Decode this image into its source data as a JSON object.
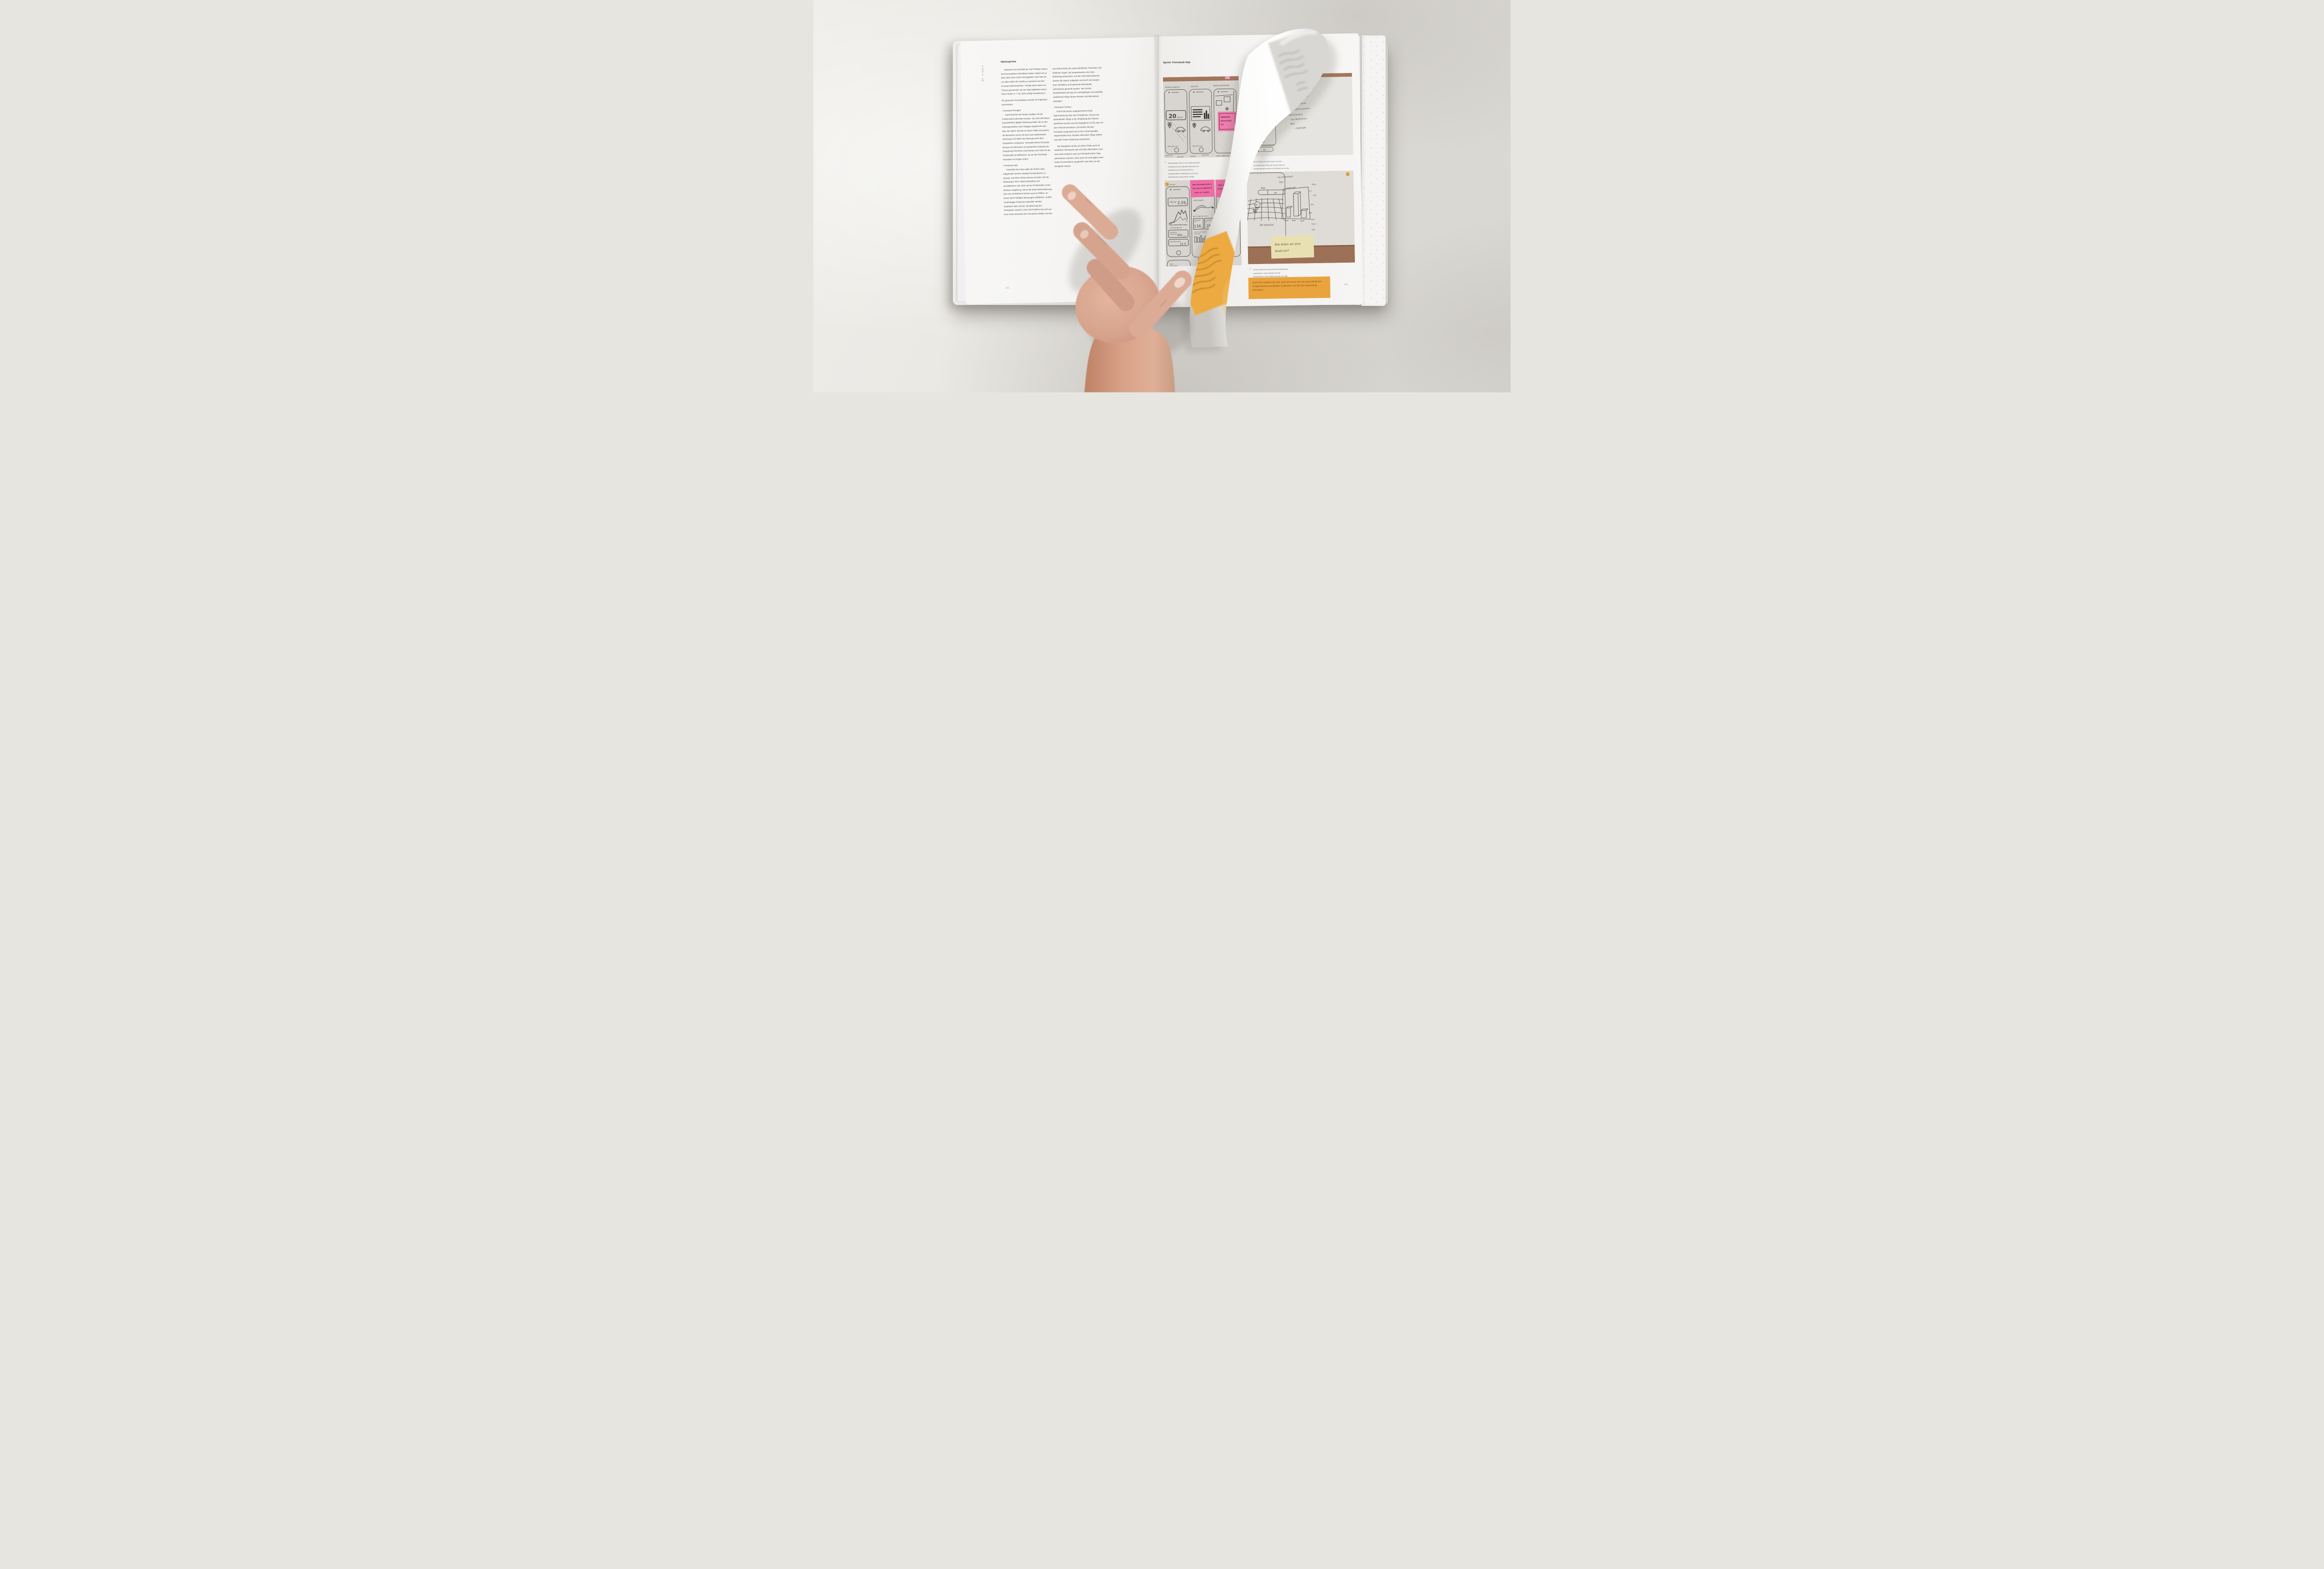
{
  "colors": {
    "accent_yellow": "#e9a43e",
    "sticky_pink": "#ee6fa6",
    "cork_brown": "#9c7157",
    "sticky_yellow": "#e9e0b2",
    "page": "#f5f4f2"
  },
  "left_page": {
    "side_label": "02 Create",
    "page_number": "182",
    "heading": "Ideensprints",
    "col1": {
      "p1": "Nachdem wir innerhalb der Top Findings unsere drei Konzeptideen identifiziert hatten, haben wir zu jeder Idee einen Sprint durchgeführt. Dies half uns vor allem dabei die Inhalte zu sammeln und das Konzept weiterzudenken. Parallel dazu haben wir Thesen gesammelt, die wie folgt aufgebaut waren: Wenn Nutzer X, Y tut, dann  erfolgt Auswirkung Z.",
      "p2": "Die gesamten Konzeptideen werden im Folgenden beschrieben:",
      "b1": "›  Feinstaub-Fernglas:",
      "p3": "Damit könnten die Nutzer häufiger mit der Problematik konfrontiert werden. Zur Zeit informieren ausschließlich digitale Reklameschilder die an den Zubringerstraßen nach Stuttgart angebracht sind über den Alarm. Bereits an dieser Stelle sind jedoch die Menschen schon mit dem Auto stadteinwärts unterwegs und haben die Warnung nach dem Vorbeifahren vergessen. Innerhalb dieses Konzepts könnten die Menschen an bestimmten Hotspots die Umgebung erforschen und könnten sich mehr für die Problematik sensibilisieren, da sie den Feinstaub visualisiert vor Augen sehen.",
      "b2": "›  Feinstaub-App:",
      "p4": "Innerhalb einer App sollen die Nutzer dazu aufgefordert werden ständig Feinstaubwerte zu messen. Auf diese Weise können sie jeder Zeit die Belastung in ihrer Stadt beobachten und sensibilisieren sich mehr mit der Problematik in ihrer direkten Umgebung. Durch die breite Datenerfassung über das Smartphone könnte auch an Stellen, an denen keine häufigen Messungen stattfinden, zeitlich unabhängige Prognosen getroffen werden. Zusätzlich dazu soll die Visualisierung des Feinstaubs sowohl in einer AR-Funktion als auch auf einer Karte einerseits den Feinstaub sichtbar machen"
    },
    "col2": {
      "p1": "und andererseits die unterschiedlichen Parameter und Einflüsse zeigen, die beispielsweise eine hohe Belastung ausmachen. Auf den Informationsebenen können die Nutzer aufgeklärt und durch die Analyse ihres Verhaltens auf bestimmte Missstände aufmerksam gemacht werden. Hier könnte beispielsweise die App für zurückgelegte und zukünftig anstehende Wege besser beraten und Alternativen aufzeigen.",
      "b1": "›  Feinstaub-Toolbox:",
      "p2": "Durch die bereits angesprochene breite Datenerfassung über das Smartphone, können die gesündesten Wege in der Umgebung des Nutzers identifiziert werden und die Navigation zu Fuß oder mit dem Fahrrad erleichtern. Die Nutzer die dem Feinstaub ausgesetzt und in ihrer Lebensqualität eingeschränkt sind, könnten alternative Wege wählen und einer hohen Belastung ausweichen.",
      "p3": "Die Navigation könnte an dieser Stelle auch für Autofahrer interessant sein und über Alternativen zum Auto unter anderem auch an Feinstaub-Alarm Tage aufmerksam machen. Denn auch sie sind täglich einer hohen Konzentration ausgesetzt, was aber nur die wenigsten wissen."
    }
  },
  "right_page": {
    "header": "Sprint: Feinstaub-App",
    "page_number": "185",
    "arrow_up": "↑",
    "caption_camera": "Kameramodus mit der Live-Visualisierung des Feinstaubs und der aktuellen Belastung. Die Visualisierung der Belastung kann in unterschiedliche Partikelgrößen, Ozon und Stickstoffoxide unterschieden werden.",
    "caption_ar_lines": {
      "l1": "der AR-View in dem der Nutzer ein Foto/",
      "l2": "ng machen kann. Damit der Nutzer sieht, wo",
      "l3": "ssungen gemacht wurden, entschieden wir uns die",
      "l4": "Quadranten zu unterteilen."
    },
    "caption_3d": "Die 3D-Ansicht der Karte soll die Feinstaubmasse verdeutlichen. Dafür verändert sich die Kartenansicht in eine Dreidimensionale und zeigt über die unterschiedlichen Quadranten die Höhe der Belastung.",
    "highlight_box": "Durch den Vergleich der Orte, kann der Nutzer sich mit unterschiedlichen Gruppen/Kommunen/Städten vergleichen und sich die Unterschiede anschauen."
  },
  "sketches": {
    "photo_a": {
      "label_visuelle": "VISUELLE ANSICHT",
      "label_infopin": "INFO PIN",
      "label_karten": "KARTEN SWITCH/PIN",
      "value_big": "20",
      "value_unit": "μm/m³",
      "tabs": "PM10  PM2.5  NOx",
      "sticky_l1": "ANALYSE",
      "sticky_l2": "-BELASTUNG",
      "sticky_l3": "-20",
      "row2_a": "STARTSCR.",
      "row2_b": "AN SICHT",
      "row2_c": "VISUELL",
      "row2_d": "AR-SICHT",
      "row2_e": "VERGL. WERTE EU"
    },
    "photo_b": {
      "h1": "Ortes",
      "h2": "· Umkreis Von 10–",
      "h2b": "in",
      "h3": "Bsp.",
      "h4": "· gemessene Werte",
      "h5": "+ dokumentation",
      "h6": "· kommentare",
      "h7": "· Von Wohnheim",
      "h8": "Bild",
      "h9": "· challenge",
      "toggle_value": "30"
    },
    "photo_c": {
      "corner": "Konzept",
      "strecke_label": "STRECKE",
      "strecke_value": "2,59",
      "strecke_unit": "km",
      "legend1": "○ FAHRRAD   ● AUTO",
      "b1l1": "GESPARTER",
      "b1l2": "FEINSTAUB",
      "b1v": "300",
      "b1u": "μm/m³",
      "b2l": "GESPARTER SPRIT",
      "b2v": "15 €",
      "s1l1": "Was wird getrackt &",
      "s1l2": "wie wird verglichen?",
      "s1l3": "Auto vs. Laufen",
      "week": "DIESE WOCHE",
      "legend2": "● AUTO   ● OHNE AUTO",
      "k1l1": "GEFAHRENE",
      "k1l2": "KM",
      "k1v": "136",
      "k1u": "km",
      "k2l1": "GELAUFENE",
      "k2l2": "KM",
      "k2v": "25",
      "k2u": "km",
      "bars1": "MEHR PRODUZIERTER",
      "bars2": "FEINSTAUB",
      "s2l1": "Tägl. Anzeige wie",
      "s2l2": "berechnet?",
      "c3a": "TÄGL.",
      "c3b": "ERREICHTE",
      "c3v": "10",
      "daily1": "DAILY",
      "daily2": "CHALLENGE"
    },
    "photo_d": {
      "map": "Map",
      "toggle": "3D",
      "bubble": "20",
      "ansicht": "3D  Ansicht",
      "n1": "· Von Wohnheim",
      "n2": "Bild",
      "n3": "· challenge",
      "n4": "Mics",
      "n5": "m³",
      "n6": "sho",
      "n7": "– fre",
      "n8": "Von",
      "n9": "sind",
      "n10": "Fein-",
      "n11": "das",
      "sticky_l1": "Wie teilen wir eine",
      "sticky_l2": "Stadt ein?"
    }
  }
}
